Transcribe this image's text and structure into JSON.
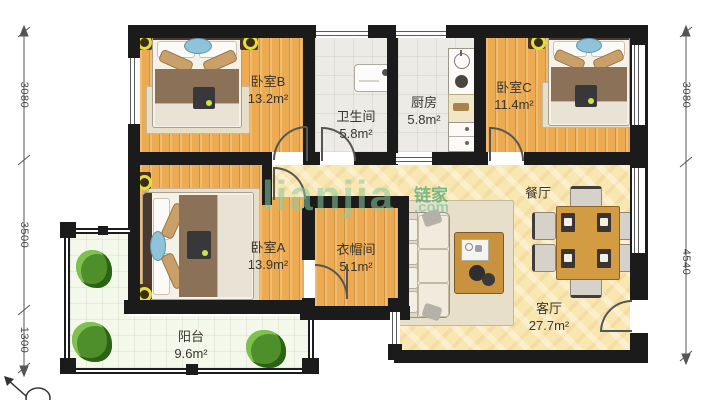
{
  "rooms": [
    {
      "id": "bedroom-b",
      "name": "卧室B",
      "area": "13.2m²"
    },
    {
      "id": "bathroom",
      "name": "卫生间",
      "area": "5.8m²"
    },
    {
      "id": "kitchen",
      "name": "厨房",
      "area": "5.8m²"
    },
    {
      "id": "bedroom-c",
      "name": "卧室C",
      "area": "11.4m²"
    },
    {
      "id": "bedroom-a",
      "name": "卧室A",
      "area": "13.9m²"
    },
    {
      "id": "cloakroom",
      "name": "衣帽间",
      "area": "5.1m²"
    },
    {
      "id": "dining",
      "name": "餐厅",
      "area": ""
    },
    {
      "id": "living",
      "name": "客厅",
      "area": "27.7m²"
    },
    {
      "id": "balcony",
      "name": "阳台",
      "area": "9.6m²"
    }
  ],
  "dimensions": {
    "left": [
      "3080",
      "3500",
      "1300"
    ],
    "right": [
      "3080",
      "4540"
    ]
  },
  "watermark": {
    "latin": "lianjia",
    "cn": "链家",
    "com": ".com"
  },
  "colors": {
    "wall": "#1b1b1b",
    "wood_floor": "#ecab51",
    "gray_tile": "#ecebe6",
    "warm_tile": "#f9e7b2",
    "balcony_floor": "#f4f8ea",
    "watermark_green": "#7cc89f"
  }
}
